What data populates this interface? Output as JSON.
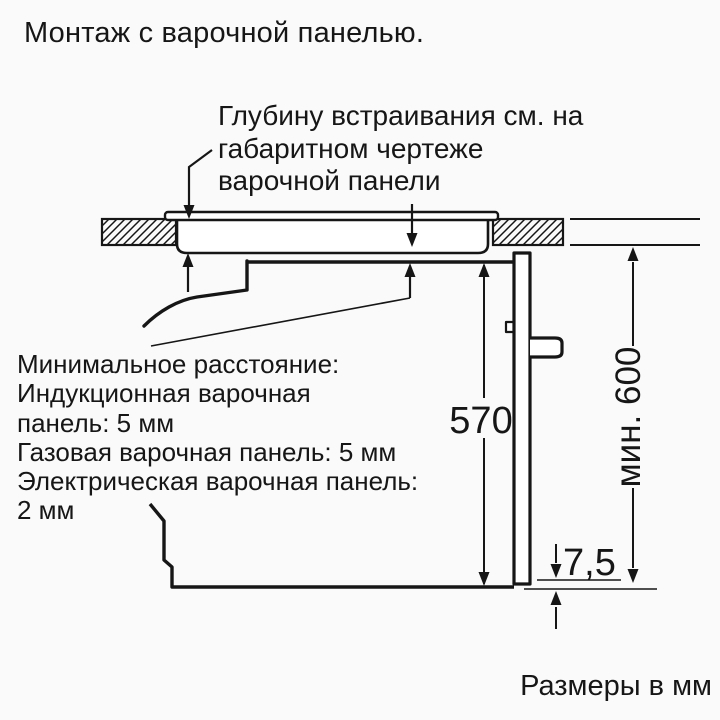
{
  "colors": {
    "ink": "#161616",
    "paper": "#fafafa"
  },
  "title": "Монтаж с варочной панелью.",
  "callout_embedding_depth": {
    "lines": [
      "Глубину встраивания см. на",
      "габаритном чертеже",
      "варочной панели"
    ]
  },
  "callout_min_distance": {
    "lines": [
      "Минимальное расстояние:",
      "Индукционная варочная",
      "панель: 5 мм",
      "Газовая варочная панель: 5 мм",
      "Электрическая варочная панель:",
      "2 мм"
    ]
  },
  "dimensions": {
    "oven_height": "570",
    "min_height": "мин. 600",
    "overlap": "7,5"
  },
  "units_note": "Размеры в мм"
}
